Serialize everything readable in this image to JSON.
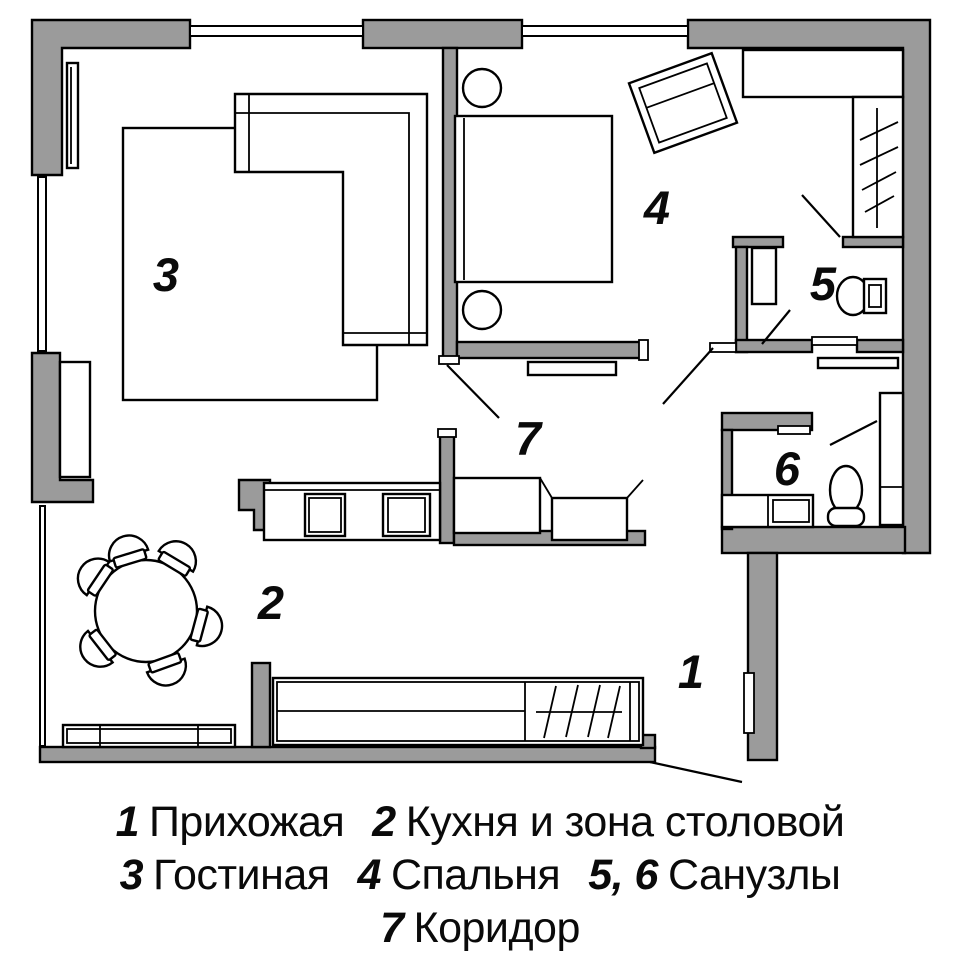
{
  "colors": {
    "wall": "#9b9b9b",
    "outline": "#000000",
    "background": "#ffffff"
  },
  "plan": {
    "labels": {
      "r1": "1",
      "r2": "2",
      "r3": "3",
      "r4": "4",
      "r5": "5",
      "r6": "6",
      "r7": "7"
    }
  },
  "legend": {
    "entries": [
      {
        "num": "1",
        "name": "Прихожая"
      },
      {
        "num": "2",
        "name": "Кухня и зона столовой"
      },
      {
        "num": "3",
        "name": "Гостиная"
      },
      {
        "num": "4",
        "name": "Спальня"
      },
      {
        "num": "5, 6",
        "name": "Санузлы"
      },
      {
        "num": "7",
        "name": "Коридор"
      }
    ]
  }
}
